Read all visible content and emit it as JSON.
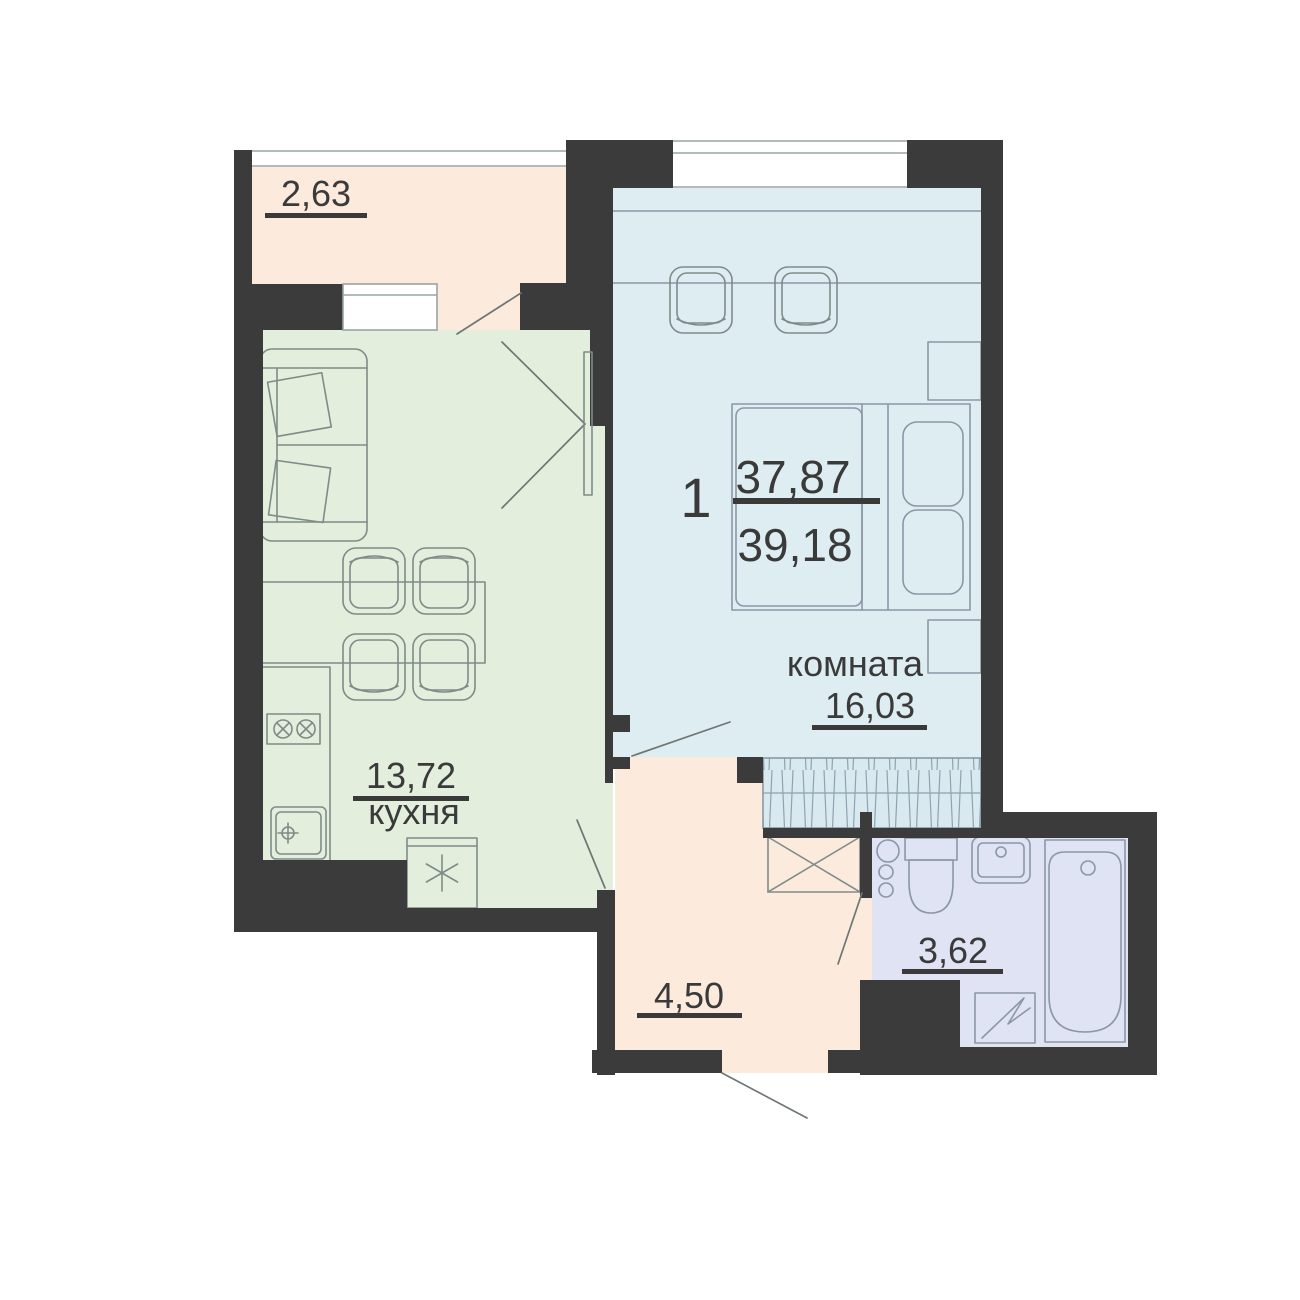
{
  "floor_plan": {
    "apartment": {
      "rooms_count": "1",
      "living_area": "37,87",
      "total_area": "39,18"
    },
    "rooms": {
      "balcony": {
        "area": "2,63",
        "color": "#fceadd"
      },
      "kitchen": {
        "name": "кухня",
        "area": "13,72",
        "color": "#e3eedd"
      },
      "room": {
        "name": "комната",
        "area": "16,03",
        "color": "#ddedf2"
      },
      "hallway": {
        "area": "4,50",
        "color": "#fceadd"
      },
      "bathroom": {
        "area": "3,62",
        "color": "#dfe3f3"
      }
    },
    "colors": {
      "walls": "#3b3b3b",
      "text": "#3a3a3a",
      "furniture_stroke": "#7e8c89",
      "closet_fill": "#d8e9ef",
      "closet_hatch": "#8fa3ae",
      "window_line": "#9aa3a3",
      "door_line": "#6f7673"
    }
  }
}
